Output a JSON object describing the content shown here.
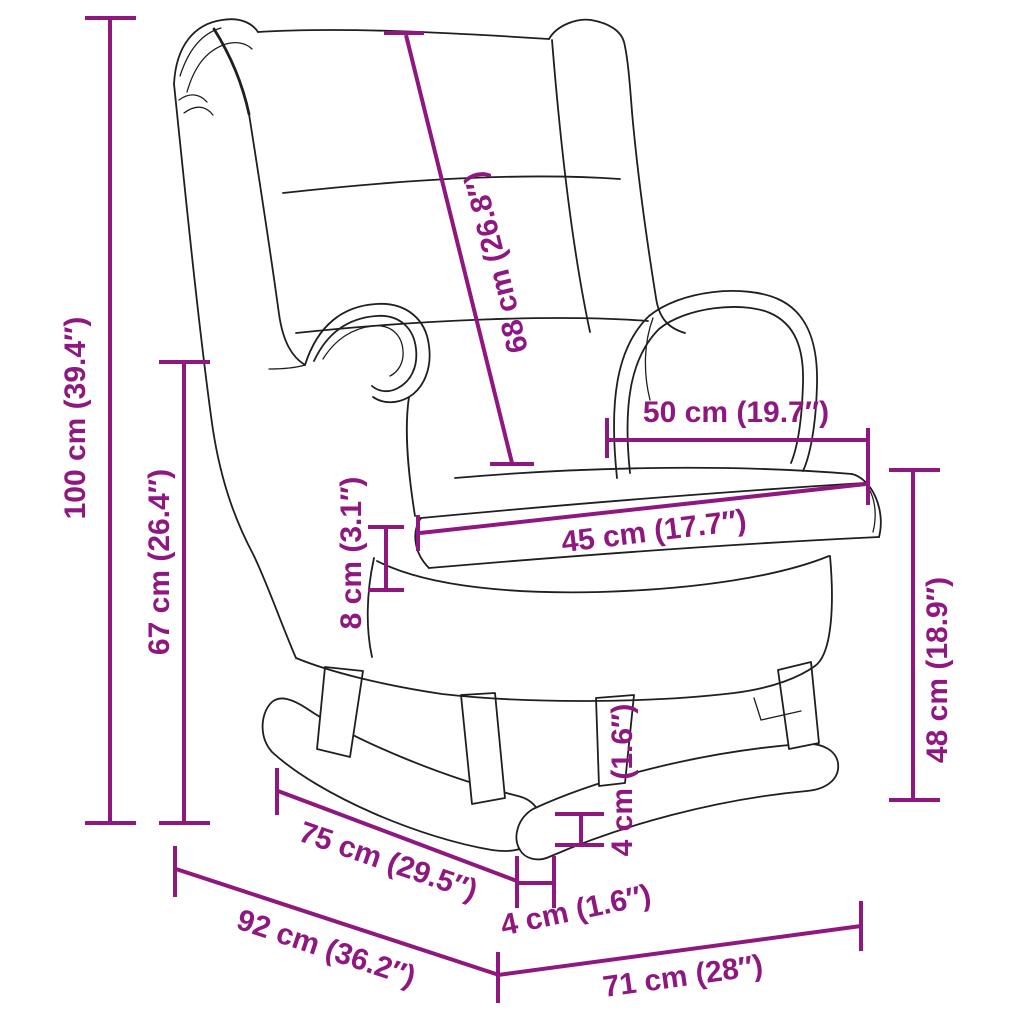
{
  "diagram": {
    "subject": "wingback rocking chair with wooden rocker legs - line drawing with dimensions",
    "accent_color": "#8E1780",
    "line_art_color": "#1f1f1f",
    "background_color": "#ffffff"
  },
  "dims": {
    "d100": {
      "label": "100 cm (39.4″)",
      "cm": 100,
      "inches": 39.4
    },
    "d67": {
      "label": "67 cm (26.4″)",
      "cm": 67,
      "inches": 26.4
    },
    "d68": {
      "label": "68 cm (26.8″)",
      "cm": 68,
      "inches": 26.8
    },
    "d50": {
      "label": "50 cm (19.7″)",
      "cm": 50,
      "inches": 19.7
    },
    "d45": {
      "label": "45 cm (17.7″)",
      "cm": 45,
      "inches": 17.7
    },
    "d8": {
      "label": "8 cm (3.1″)",
      "cm": 8,
      "inches": 3.1
    },
    "d48": {
      "label": "48 cm (18.9″)",
      "cm": 48,
      "inches": 18.9
    },
    "d4v": {
      "label": "4 cm (1.6″)",
      "cm": 4,
      "inches": 1.6
    },
    "d75": {
      "label": "75 cm (29.5″)",
      "cm": 75,
      "inches": 29.5
    },
    "d4b": {
      "label": "4 cm (1.6″)",
      "cm": 4,
      "inches": 1.6
    },
    "d92": {
      "label": "92 cm (36.2″)",
      "cm": 92,
      "inches": 36.2
    },
    "d71": {
      "label": "71 cm (28″)",
      "cm": 71,
      "inches": 28
    }
  }
}
